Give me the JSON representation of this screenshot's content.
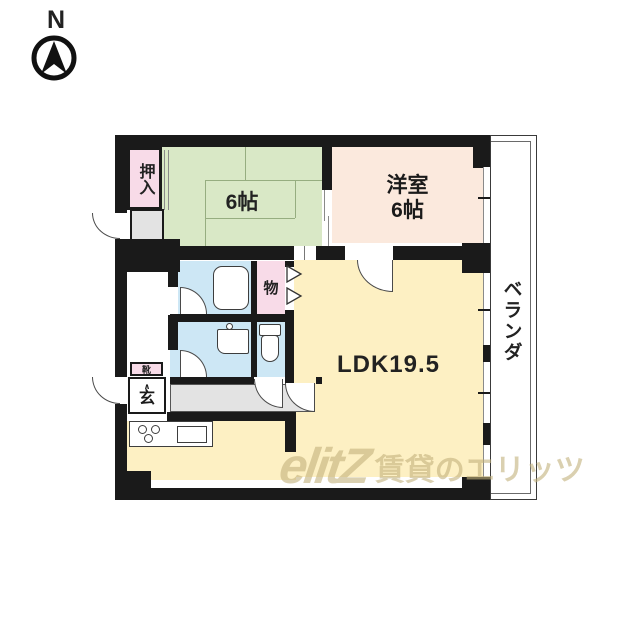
{
  "compass": {
    "north_label": "N"
  },
  "plan": {
    "rooms": {
      "closet": {
        "label": "押入"
      },
      "tatami_room": {
        "label": "6帖"
      },
      "western_room": {
        "label_line1": "洋室",
        "label_line2": "6帖"
      },
      "storage": {
        "label": "物"
      },
      "ldk": {
        "label": "LDK19.5"
      },
      "veranda": {
        "label": "ベランダ"
      },
      "entrance": {
        "label": "玄",
        "step_mark": "∧"
      },
      "shoe_cabinet": {
        "label": "靴"
      }
    },
    "colors": {
      "wall": "#1a1a1a",
      "tatami_green": "#d9e8c6",
      "closet_pink": "#f8dbe8",
      "western_peach": "#fbe9dd",
      "ldk_yellow": "#fdf0c3",
      "wet_area_blue": "#cde7f5",
      "corridor_gray": "#e3e3e3"
    }
  },
  "watermark": {
    "logo": "elitZ",
    "text": "賃貸のエリッツ"
  }
}
